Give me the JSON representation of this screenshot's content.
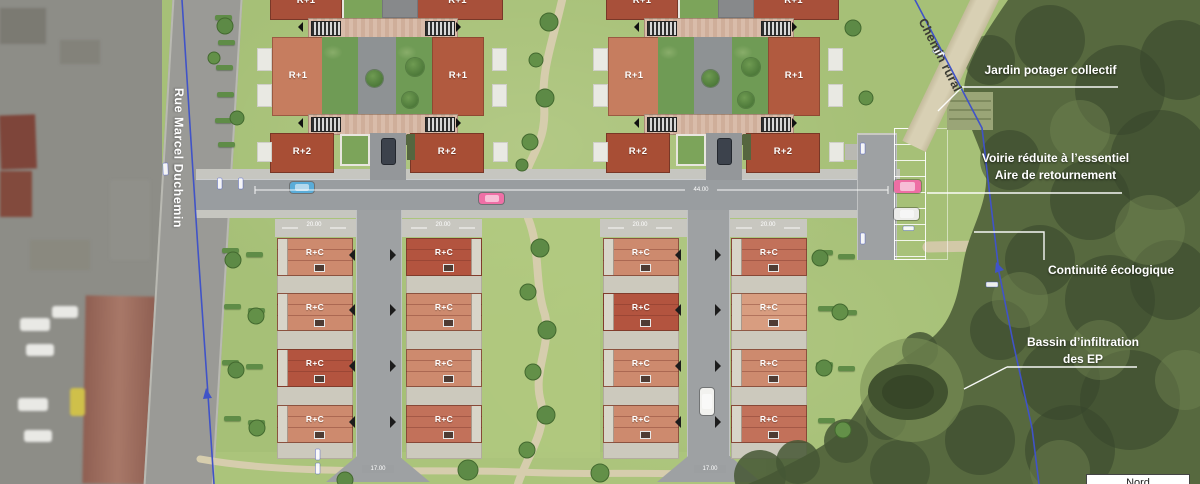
{
  "labels": {
    "r_plus_1": "R+1",
    "r_plus_2": "R+2",
    "r_plus_c": "R+C"
  },
  "streets": {
    "left_road": "Rue Marcel Duchemin",
    "rural_path": "Chemin rural"
  },
  "annotations": {
    "garden": "Jardin potager collectif",
    "road_note_line1": "Voirie réduite à l’essentiel",
    "road_note_line2": "Aire de retournement",
    "ecology": "Continuité écologique",
    "basin_line1": "Bassin d’infiltration",
    "basin_line2": "des EP"
  },
  "north": {
    "label": "Nord"
  },
  "dimensions": {
    "main_road": "44.00",
    "house_block": "20.00",
    "road_end": "17.00"
  },
  "colors": {
    "lawn": "#a6c077",
    "woods": "#57693f",
    "asphalt": "#999da0",
    "sidewalk": "#c6c6c0",
    "boundary_blue": "#4053c8",
    "path_tan": "#d6cdad",
    "building_dark_red": "#a84e35",
    "wing_light": "#c67d5f",
    "wing_dark": "#b15a3f"
  },
  "complexes": [
    {
      "id": "west",
      "x": 250
    },
    {
      "id": "east",
      "x": 586
    }
  ],
  "house_grid": {
    "rows_y": [
      238,
      293,
      349,
      405
    ],
    "columns": [
      {
        "x": 277,
        "strip": "left",
        "road": "right",
        "shades": [
          "salmon",
          "salmon",
          "dark",
          "salmon"
        ]
      },
      {
        "x": 406,
        "strip": "right",
        "road": "left",
        "shades": [
          "dark",
          "salmon",
          "salmon",
          "medium"
        ]
      },
      {
        "x": 603,
        "strip": "left",
        "road": "right",
        "shades": [
          "salmon",
          "dark",
          "salmon",
          "salmon"
        ]
      },
      {
        "x": 731,
        "strip": "left",
        "road": "left",
        "shades": [
          "medium",
          "light",
          "salmon",
          "medium"
        ]
      }
    ],
    "shade_colors": {
      "light": "#d89d80",
      "salmon": "#cd8a6e",
      "medium": "#c2715a",
      "dark": "#b3543f"
    }
  }
}
